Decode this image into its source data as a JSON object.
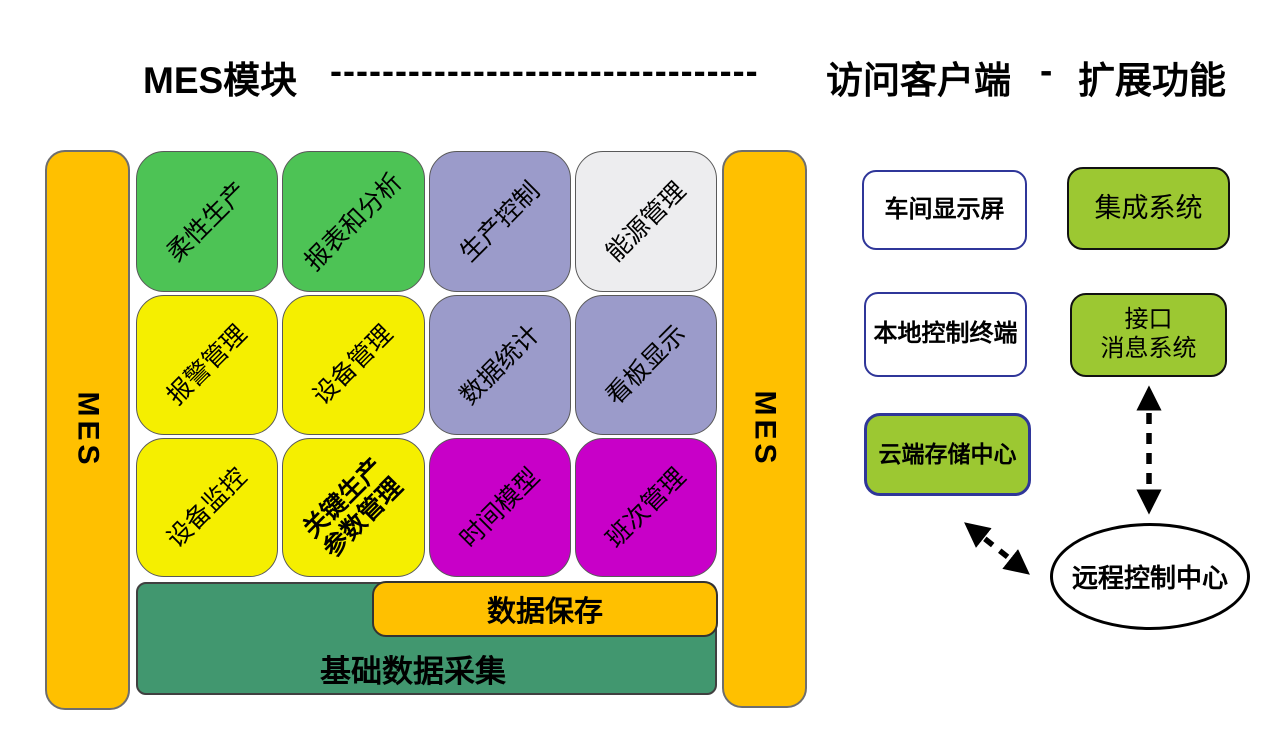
{
  "title": {
    "mes_modules": "MES模块",
    "dashes": "---------------------------------",
    "access_clients": "访问客户端",
    "separator": "-",
    "extensions": "扩展功能"
  },
  "side_bars": {
    "left_label": "MES",
    "right_label": "MES"
  },
  "grid": {
    "cells": [
      {
        "line1": "柔性生产",
        "color": "green"
      },
      {
        "line1": "报表和分析",
        "color": "green"
      },
      {
        "line1": "生产控制",
        "color": "lavender"
      },
      {
        "line1": "能源管理",
        "color": "light-gray"
      },
      {
        "line1": "报警管理",
        "color": "yellow"
      },
      {
        "line1": "设备管理",
        "color": "yellow"
      },
      {
        "line1": "数据统计",
        "color": "lavender"
      },
      {
        "line1": "看板显示",
        "color": "lavender"
      },
      {
        "line1": "设备监控",
        "color": "yellow"
      },
      {
        "line1": "关键生产",
        "line2": "参数管理",
        "color": "yellow",
        "bold": true
      },
      {
        "line1": "时间模型",
        "color": "magenta"
      },
      {
        "line1": "班次管理",
        "color": "magenta"
      }
    ]
  },
  "bottom": {
    "data_save": "数据保存",
    "base_data_collection": "基础数据采集"
  },
  "clients": {
    "workshop_display": "车间显示屏",
    "local_control_terminal": "本地控制终端",
    "cloud_storage_center": "云端存储中心"
  },
  "extensions": {
    "integrated_system": "集成系统",
    "interface_line1": "接口",
    "interface_line2": "消息系统",
    "remote_control_center": "远程控制中心"
  },
  "colors": {
    "gold": "#FFC000",
    "green": "#4DC355",
    "yellow": "#F5EF00",
    "lavender": "#9B9BCA",
    "light_gray": "#EDEDEF",
    "magenta": "#C800C8",
    "sea_green": "#41976F",
    "yellow_green": "#9CC832",
    "navy_border": "#2F3699",
    "text": "#000000"
  }
}
